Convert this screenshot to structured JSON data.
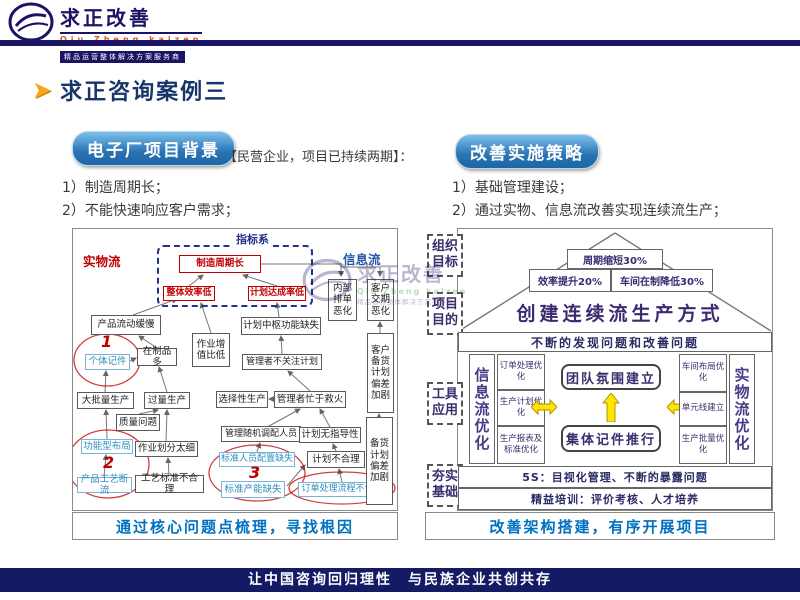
{
  "header": {
    "logo_title": "求正改善",
    "logo_subtitle": "Qiu Zheng kaizen",
    "logo_tagline": "精品运营整体解决方案服务商"
  },
  "page": {
    "title": "求正咨询案例三"
  },
  "left": {
    "pill": "电子厂项目背景",
    "note": "【民营企业，项目已持续两期】：",
    "bullets": [
      "1）制造周期长；",
      "2）不能快速响应客户需求；"
    ],
    "diagram": {
      "label_physical": "实物流",
      "label_indicator": "指标系",
      "label_info": "信息流",
      "nodes": {
        "mfg_cycle": "制造周期长",
        "overall_eff": "整体效率低",
        "plan_rate": "计划达成率低",
        "product_flow_slow": "产品流动缓慢",
        "plan_hub": "计划中枢功能缺失",
        "internal_worse": "内部排单恶化",
        "customer_worse": "客户交期恶化",
        "piece_rate": "个体记件",
        "wip_high": "在制品多",
        "value_ratio": "作业增值比低",
        "batch_prod": "大批量生产",
        "over_prod": "过量生产",
        "selective_prod": "选择性生产",
        "mgr_ignore": "管理者不关注计划",
        "mgr_firefight": "管理者忙于救火",
        "quality": "质量问题",
        "random_staff": "管理随机调配人员",
        "plan_no_guide": "计划无指导性",
        "func_layout": "功能型布局",
        "work_split": "作业划分太细",
        "std_staff": "标准人员配置缺失",
        "plan_bad": "计划不合理",
        "flow_break": "产品工艺断流",
        "process_std": "工艺标准不合理",
        "std_capacity": "标准产能缺失",
        "order_flow_bad": "订单处理流程不合理",
        "cust_stock": "客户备货计划偏差加剧",
        "stock": "备货计划偏差加剧"
      },
      "markers": [
        "1",
        "2",
        "3"
      ],
      "caption": "通过核心问题点梳理，寻找根因"
    }
  },
  "right": {
    "pill": "改善实施策略",
    "bullets": [
      "1）基础管理建设；",
      "2）通过实物、信息流改善实现连续流生产；"
    ],
    "diagram": {
      "side_labels": [
        "组织目标",
        "项目目的",
        "工具应用",
        "夯实基础"
      ],
      "roof_top": "周期缩短30%",
      "roof_left": "效率提升20%",
      "roof_right": "车间在制降低30%",
      "roof_slogan": "创建连续流生产方式",
      "banner": "不断的发现问题和改善问题",
      "info_col_title": "信息流优化",
      "info_items": [
        "订单处理优化",
        "生产计划优化",
        "生产报表及标准优化"
      ],
      "center_items": [
        "团队氛围建立",
        "集体记件推行"
      ],
      "phys_items": [
        "车间布局优化",
        "单元线建立",
        "生产批量优化"
      ],
      "phys_col_title": "实物流优化",
      "base_rows": [
        "5S：目视化管理、不断的暴露问题",
        "精益培训：评价考核、人才培养"
      ],
      "caption": "改善架构搭建，有序开展项目"
    }
  },
  "watermark": {
    "title": "求正改善",
    "subtitle": "Qiu Zheng kaizen",
    "tagline": "精品运营整体解决方案服务商"
  },
  "footer": "让中国咨询回归理性　与民族企业共创共存",
  "colors": {
    "navy": "#1b1464",
    "red": "#c00000",
    "teal_blue": "#2d8fc0",
    "purple": "#3b2a70",
    "caption_blue": "#0070c0",
    "pill_blue": "#2a74b5",
    "yellow": "#ffe600"
  }
}
